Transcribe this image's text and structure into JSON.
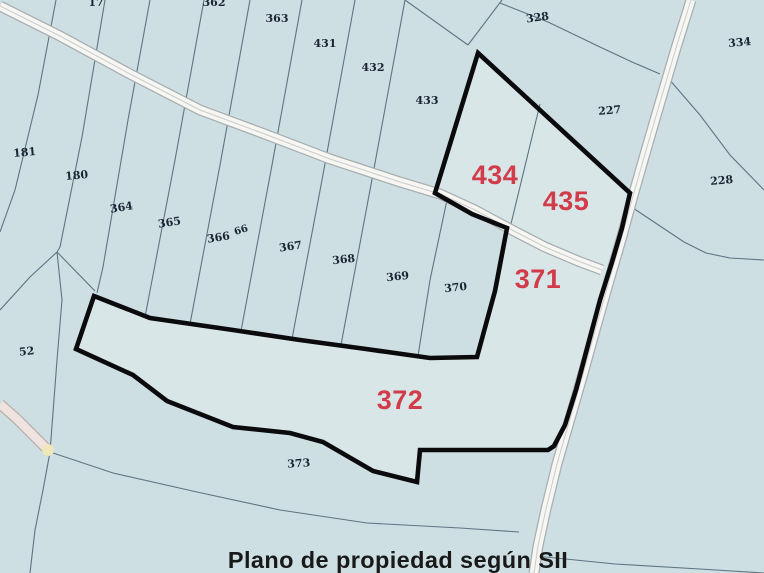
{
  "title_caption": "Plano de propiedad según SII",
  "map": {
    "width": 764,
    "height": 573,
    "colors": {
      "background": "#cddfe3",
      "highlight_fill": "#d8e6e7",
      "thin_line": "#5f7482",
      "thick_boundary": "#0b0b0d",
      "road_edge": "#a6aeb0",
      "road_fill": "#f7f6f2",
      "road_center": "#c9cdcd",
      "side_road_edge": "#b9aeaa",
      "side_road_fill": "#eee3de",
      "side_road_tip": "#f0e7bb",
      "parcel_label": "#1b2433",
      "highlight_label": "#d23b49",
      "caption_color": "#191919"
    },
    "boundary_polygon": [
      [
        478,
        53
      ],
      [
        630,
        193
      ],
      [
        622,
        228
      ],
      [
        612,
        262
      ],
      [
        600,
        300
      ],
      [
        588,
        345
      ],
      [
        576,
        390
      ],
      [
        565,
        425
      ],
      [
        554,
        446
      ],
      [
        548,
        450
      ],
      [
        420,
        450
      ],
      [
        417,
        482
      ],
      [
        373,
        471
      ],
      [
        323,
        442
      ],
      [
        290,
        433
      ],
      [
        233,
        427
      ],
      [
        167,
        401
      ],
      [
        133,
        375
      ],
      [
        76,
        349
      ],
      [
        94,
        296
      ],
      [
        150,
        318
      ],
      [
        233,
        330
      ],
      [
        300,
        340
      ],
      [
        366,
        349
      ],
      [
        430,
        358
      ],
      [
        477,
        357
      ],
      [
        495,
        291
      ],
      [
        507,
        228
      ],
      [
        472,
        214
      ],
      [
        435,
        193
      ]
    ],
    "roads": {
      "main_road": [
        [
          0,
          6
        ],
        [
          60,
          36
        ],
        [
          130,
          74
        ],
        [
          200,
          110
        ],
        [
          262,
          133
        ],
        [
          330,
          159
        ],
        [
          400,
          182
        ],
        [
          440,
          194
        ],
        [
          475,
          210
        ],
        [
          512,
          230
        ],
        [
          545,
          247
        ],
        [
          578,
          261
        ],
        [
          602,
          270
        ]
      ],
      "vertical_road": [
        [
          691,
          0
        ],
        [
          676,
          48
        ],
        [
          661,
          99
        ],
        [
          647,
          147
        ],
        [
          633,
          196
        ],
        [
          621,
          240
        ],
        [
          609,
          281
        ],
        [
          596,
          327
        ],
        [
          583,
          374
        ],
        [
          570,
          419
        ],
        [
          557,
          464
        ],
        [
          546,
          509
        ],
        [
          538,
          546
        ],
        [
          534,
          573
        ]
      ],
      "small_road": [
        [
          0,
          404
        ],
        [
          18,
          420
        ],
        [
          38,
          440
        ],
        [
          50,
          452
        ]
      ],
      "small_road_tip": [
        48,
        450
      ]
    },
    "thin_lines": [
      {
        "name": "strip-181-180",
        "pts": [
          [
            56,
            0
          ],
          [
            38,
            95
          ],
          [
            15,
            190
          ],
          [
            0,
            232
          ]
        ]
      },
      {
        "name": "strip-180-364",
        "pts": [
          [
            105,
            0
          ],
          [
            82,
            137
          ],
          [
            60,
            247
          ],
          [
            57,
            252
          ]
        ]
      },
      {
        "name": "parcel52-northeast",
        "pts": [
          [
            57,
            252
          ],
          [
            95,
            291
          ]
        ]
      },
      {
        "name": "parcel52-east",
        "pts": [
          [
            57,
            252
          ],
          [
            62,
            300
          ],
          [
            57,
            360
          ],
          [
            50,
            452
          ],
          [
            43,
            490
          ],
          [
            35,
            530
          ],
          [
            30,
            573
          ]
        ]
      },
      {
        "name": "parcel52-west",
        "pts": [
          [
            57,
            252
          ],
          [
            30,
            277
          ],
          [
            0,
            310
          ]
        ]
      },
      {
        "name": "strip-364-365",
        "pts": [
          [
            150,
            0
          ],
          [
            128,
            120
          ],
          [
            103,
            267
          ],
          [
            97,
            293
          ]
        ]
      },
      {
        "name": "strip-365-366",
        "pts": [
          [
            204,
            0
          ],
          [
            175,
            160
          ],
          [
            145,
            317
          ]
        ]
      },
      {
        "name": "strip-366-367",
        "pts": [
          [
            250,
            0
          ],
          [
            220,
            165
          ],
          [
            190,
            324
          ]
        ]
      },
      {
        "name": "strip-367-368",
        "pts": [
          [
            302,
            0
          ],
          [
            272,
            165
          ],
          [
            241,
            331
          ]
        ]
      },
      {
        "name": "strip-368-369",
        "pts": [
          [
            355,
            0
          ],
          [
            322,
            180
          ],
          [
            292,
            339
          ]
        ]
      },
      {
        "name": "strip-369-370",
        "pts": [
          [
            405,
            0
          ],
          [
            373,
            174
          ],
          [
            341,
            345
          ]
        ]
      },
      {
        "name": "strip-370-371",
        "pts": [
          [
            447,
            200
          ],
          [
            430,
            280
          ],
          [
            418,
            356
          ]
        ]
      },
      {
        "name": "divider-434-435",
        "pts": [
          [
            540,
            104
          ],
          [
            510,
            228
          ]
        ]
      },
      {
        "name": "wedge-328-west",
        "pts": [
          [
            405,
            0
          ],
          [
            468,
            45
          ]
        ]
      },
      {
        "name": "wedge-328-east",
        "pts": [
          [
            502,
            0
          ],
          [
            468,
            45
          ]
        ]
      },
      {
        "name": "boundary-227-north",
        "pts": [
          [
            500,
            3
          ],
          [
            548,
            22
          ],
          [
            600,
            47
          ],
          [
            632,
            62
          ],
          [
            660,
            74
          ]
        ]
      },
      {
        "name": "boundary-334-228",
        "pts": [
          [
            668,
            78
          ],
          [
            700,
            115
          ],
          [
            730,
            155
          ],
          [
            764,
            190
          ]
        ]
      },
      {
        "name": "boundary-228-south",
        "pts": [
          [
            633,
            208
          ],
          [
            660,
            226
          ],
          [
            684,
            242
          ],
          [
            706,
            253
          ],
          [
            730,
            258
          ],
          [
            764,
            260
          ]
        ]
      },
      {
        "name": "boundary-373-south",
        "pts": [
          [
            50,
            452
          ],
          [
            113,
            473
          ],
          [
            197,
            492
          ],
          [
            280,
            510
          ],
          [
            367,
            523
          ],
          [
            460,
            528
          ],
          [
            519,
            532
          ]
        ]
      },
      {
        "name": "boundary-southeast",
        "pts": [
          [
            536,
            556
          ],
          [
            615,
            564
          ],
          [
            700,
            569
          ],
          [
            764,
            573
          ]
        ]
      }
    ],
    "parcel_labels": [
      {
        "text": "181",
        "x": 25,
        "y": 156,
        "rot": -5
      },
      {
        "text": "180",
        "x": 77,
        "y": 179,
        "rot": -5
      },
      {
        "text": "364",
        "x": 122,
        "y": 211,
        "rot": -9
      },
      {
        "text": "365",
        "x": 170,
        "y": 226,
        "rot": -9
      },
      {
        "text": "366",
        "x": 219,
        "y": 241,
        "rot": -9
      },
      {
        "text": "66",
        "x": 242,
        "y": 233,
        "rot": -18,
        "size": 10
      },
      {
        "text": "367",
        "x": 291,
        "y": 250,
        "rot": -8
      },
      {
        "text": "368",
        "x": 344,
        "y": 263,
        "rot": -6
      },
      {
        "text": "369",
        "x": 398,
        "y": 280,
        "rot": -6
      },
      {
        "text": "370",
        "x": 456,
        "y": 291,
        "rot": -6
      },
      {
        "text": "363",
        "x": 277,
        "y": 22,
        "rot": 0
      },
      {
        "text": "431",
        "x": 325,
        "y": 47,
        "rot": 0
      },
      {
        "text": "432",
        "x": 373,
        "y": 71,
        "rot": 0
      },
      {
        "text": "433",
        "x": 427,
        "y": 104,
        "rot": 0
      },
      {
        "text": "328",
        "x": 538,
        "y": 21,
        "rot": -8
      },
      {
        "text": "334",
        "x": 740,
        "y": 46,
        "rot": -5
      },
      {
        "text": "227",
        "x": 610,
        "y": 114,
        "rot": -5
      },
      {
        "text": "228",
        "x": 722,
        "y": 184,
        "rot": -5
      },
      {
        "text": "52",
        "x": 27,
        "y": 355,
        "rot": -6
      },
      {
        "text": "373",
        "x": 299,
        "y": 467,
        "rot": -4
      },
      {
        "text": "17",
        "x": 96,
        "y": 6,
        "rot": 0,
        "partial": true
      },
      {
        "text": "362",
        "x": 214,
        "y": 6,
        "rot": 0,
        "partial": true
      }
    ],
    "highlight_labels": [
      {
        "text": "434",
        "x": 495,
        "y": 184
      },
      {
        "text": "435",
        "x": 566,
        "y": 210
      },
      {
        "text": "371",
        "x": 538,
        "y": 288
      },
      {
        "text": "372",
        "x": 400,
        "y": 409
      }
    ]
  }
}
